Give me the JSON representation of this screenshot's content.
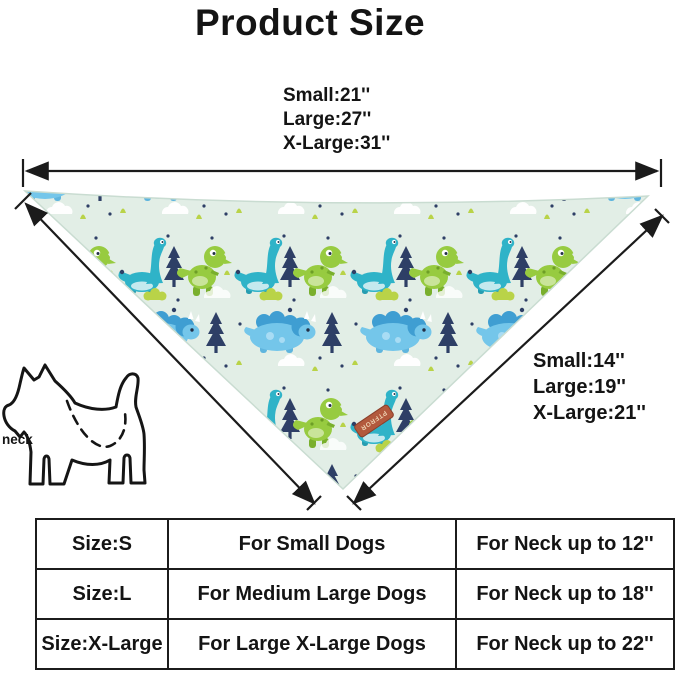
{
  "title": "Product Size",
  "top_measurements": {
    "lines": [
      "Small:21''",
      "Large:27''",
      "X-Large:31''"
    ]
  },
  "side_measurements": {
    "lines": [
      "Small:14''",
      "Large:19''",
      "X-Large:21''"
    ]
  },
  "neck_label": "neck",
  "tag_text": "PTFROR",
  "size_table": {
    "rows": [
      {
        "size": "Size:S",
        "dogs": "For Small Dogs",
        "neck": "For Neck up to 12''"
      },
      {
        "size": "Size:L",
        "dogs": "For Medium Large Dogs",
        "neck": "For Neck up to 18''"
      },
      {
        "size": "Size:X-Large",
        "dogs": "For Large X-Large Dogs",
        "neck": "For Neck up to 22''"
      }
    ]
  },
  "colors": {
    "line_black": "#1b1b1b",
    "fabric_bg": "#e2eee6",
    "triceratops_blue": "#74c6ea",
    "bronto_teal": "#2fb3c8",
    "trex_green": "#97cb40",
    "tree_navy": "#2e3f66",
    "bush_lime": "#b9d348",
    "tag_brown": "#b2593d"
  }
}
